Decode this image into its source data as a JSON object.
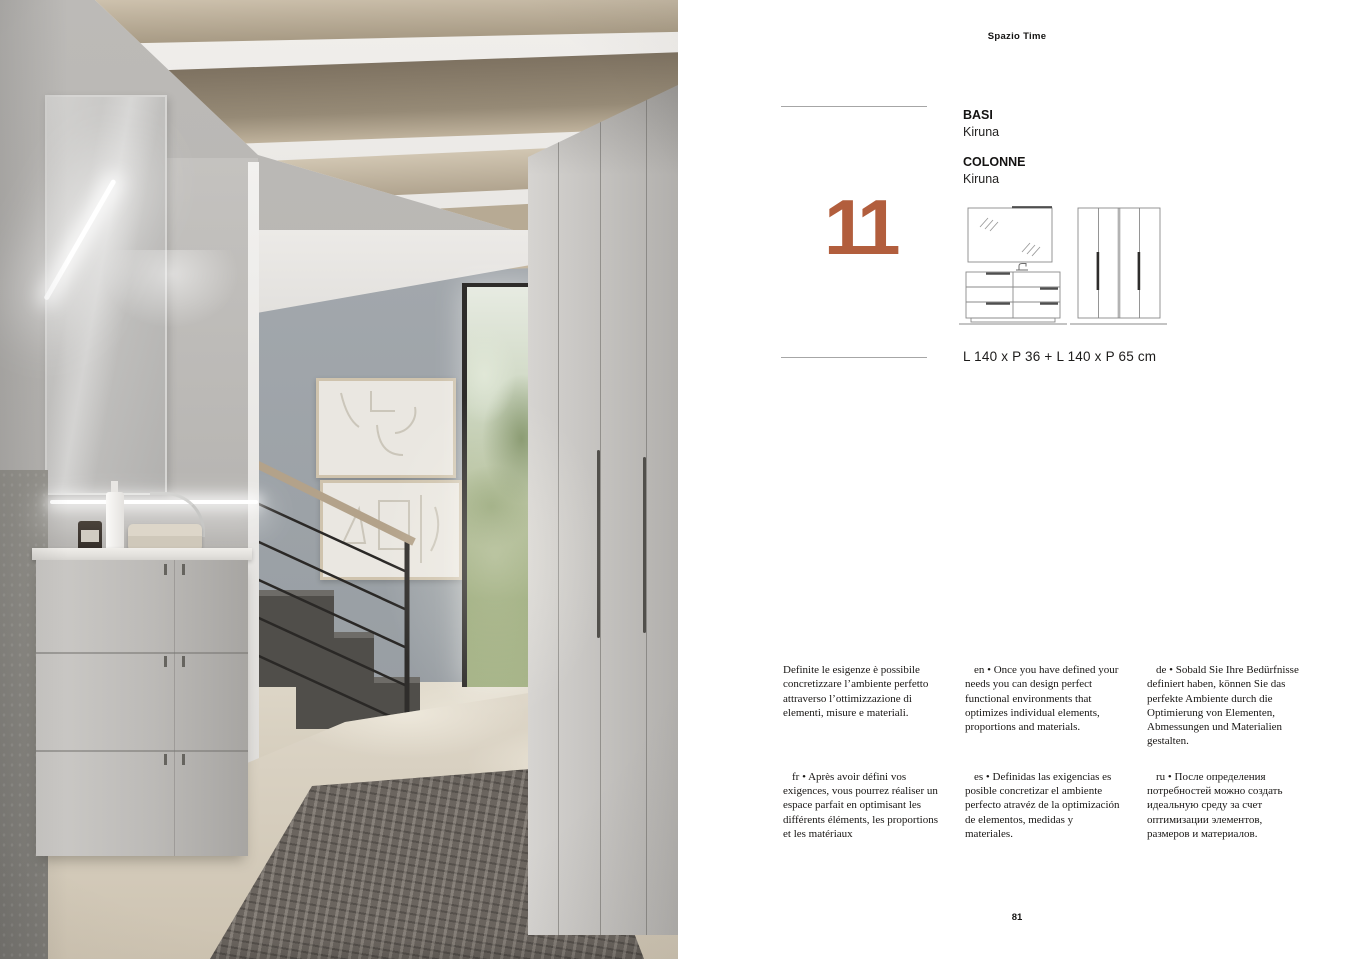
{
  "page": {
    "brand": "Spazio Time",
    "page_number": "81"
  },
  "product": {
    "number": "11",
    "groups": [
      {
        "label": "BASI",
        "value": "Kiruna"
      },
      {
        "label": "COLONNE",
        "value": "Kiruna"
      }
    ],
    "dimensions": "L 140 x P 36 + L 140 x P 65 cm"
  },
  "descriptions": [
    {
      "lang": "it",
      "text": "Definite le esigenze è possibile concretizzare l’ambiente perfetto attraverso l’ottimizzazione di elementi, misure e materiali."
    },
    {
      "lang": "en",
      "text": "en • Once you have defined your needs you can design perfect functional environments that optimizes individual elements, proportions and materials."
    },
    {
      "lang": "de",
      "text": "de • Sobald Sie Ihre Bedürfnisse definiert haben, können Sie das perfekte Ambiente durch die Optimierung von Elementen, Abmessungen und Materialien gestalten."
    },
    {
      "lang": "fr",
      "text": "fr • Après avoir défini vos exigences, vous pourrez réaliser un espace parfait en optimisant les différents éléments, les proportions et les matériaux"
    },
    {
      "lang": "es",
      "text": "es • Definidas las exigencias es posible concretizar el ambiente perfecto atravéz de la optimización de elementos, medidas y materiales."
    },
    {
      "lang": "ru",
      "text": "ru • После определения потребностей можно создать идеальную среду за счет оптимизации элементов, размеров и материалов."
    }
  ],
  "colors": {
    "accent": "#B25E3D",
    "rule": "#A6A6A6"
  }
}
